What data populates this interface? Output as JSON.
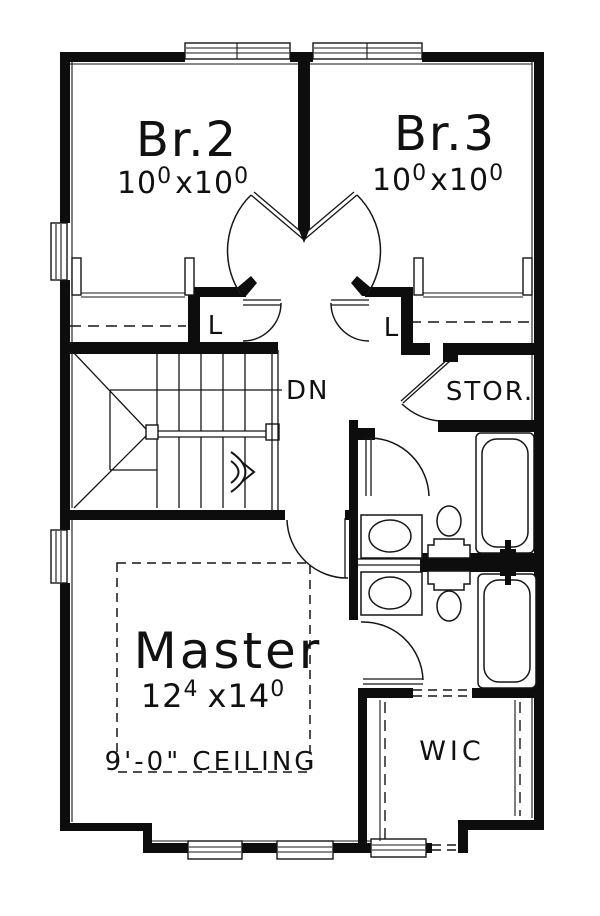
{
  "colors": {
    "ink": "#0d0d0d",
    "paper": "#ffffff"
  },
  "rooms": {
    "br2": {
      "name": "Br.2",
      "dim_a": "10",
      "dim_a_sup": "0",
      "dim_b": "x10",
      "dim_b_sup": "0"
    },
    "br3": {
      "name": "Br.3",
      "dim_a": "10",
      "dim_a_sup": "0",
      "dim_b": "x10",
      "dim_b_sup": "0"
    },
    "master": {
      "name": "Master",
      "dim_a": "12",
      "dim_a_sup": "4",
      "dim_b": "x14",
      "dim_b_sup": "0",
      "ceiling_note": "9'-0\" CEILING"
    },
    "wic": {
      "name": "WIC"
    },
    "storage": {
      "name": "STOR."
    },
    "linen_left": {
      "abbr": "L"
    },
    "linen_right": {
      "abbr": "L"
    },
    "stairs": {
      "direction_label": "DN"
    }
  }
}
